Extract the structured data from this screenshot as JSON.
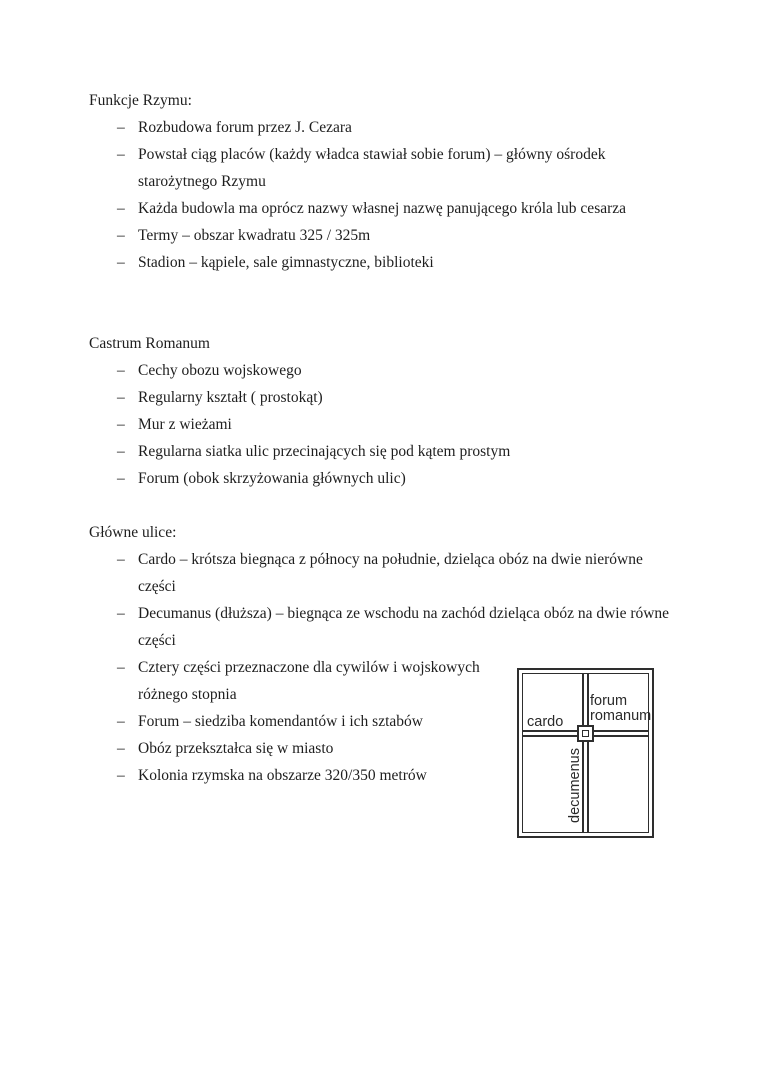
{
  "page": {
    "bullet_char": "–",
    "text_color": "#1e1e1e",
    "background_color": "#ffffff",
    "sections": [
      {
        "heading": "Funkcje Rzymu:",
        "items": [
          "Rozbudowa forum przez J. Cezara",
          "Powstał ciąg placów (każdy władca stawiał sobie forum) – główny ośrodek\nstarożytnego Rzymu",
          "Każda budowla ma oprócz nazwy własnej nazwę panującego króla lub cesarza",
          "Termy – obszar kwadratu 325 / 325m",
          "Stadion – kąpiele, sale gimnastyczne, biblioteki"
        ]
      },
      {
        "heading": "Castrum Romanum",
        "items": [
          "Cechy obozu wojskowego",
          "Regularny kształt ( prostokąt)",
          "Mur z wieżami",
          "Regularna siatka ulic przecinających się pod kątem prostym",
          "Forum (obok skrzyżowania głównych ulic)"
        ]
      },
      {
        "heading": "Główne ulice:",
        "items": [
          "Cardo – krótsza biegnąca z północy na południe, dzieląca obóz na dwie nierówne\nczęści",
          "Decumanus (dłuższa) – biegnąca ze wschodu na zachód dzieląca obóz na dwie równe\nczęści",
          "Cztery części przeznaczone dla cywilów i wojskowych\nróżnego stopnia",
          "Forum – siedziba komendantów i ich sztabów",
          "Obóz przekształca się w miasto",
          "Kolonia rzymska na obszarze 320/350 metrów"
        ]
      }
    ]
  },
  "diagram": {
    "line_color": "#2e2e2e",
    "labels": {
      "cardo": "cardo",
      "forum_romanum": "forum\nromanum",
      "decumanus": "decumenus"
    }
  }
}
